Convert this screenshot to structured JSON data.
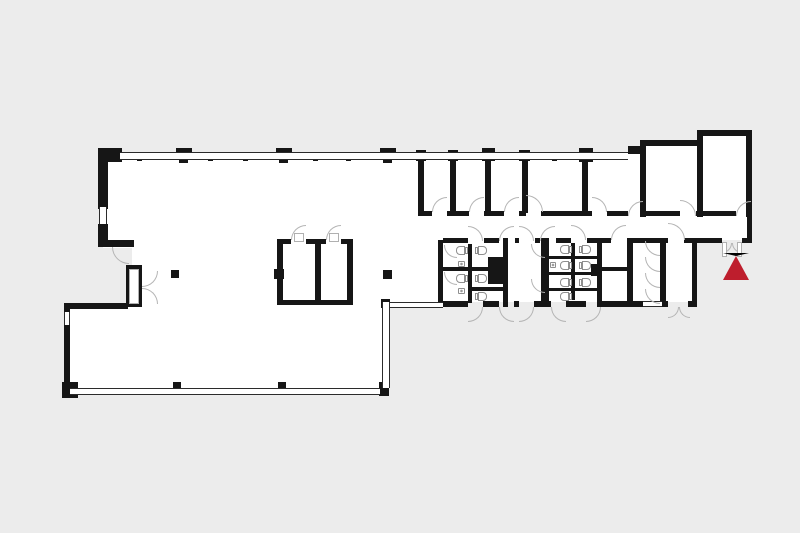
{
  "title": "Building floor plan with entrance marker",
  "canvas": {
    "width": 800,
    "height": 533
  },
  "colors": {
    "background": "#ececec",
    "floor": "#ffffff",
    "wall": "#161616",
    "window_line": "#2b2b2b",
    "door_arc": "#b5b5b5",
    "fixture_line": "#8f8f8f",
    "marker": "#be1e2d"
  },
  "marker": {
    "name": "entrance-marker",
    "apex_x": 736,
    "apex_y": 253,
    "half_width": 13,
    "height": 24
  },
  "floor_plan": {
    "floors": [
      [
        103,
        153,
        315,
        95
      ],
      [
        132,
        246,
        286,
        60
      ],
      [
        70,
        306,
        315,
        84
      ],
      [
        388,
        216,
        55,
        86
      ],
      [
        418,
        153,
        334,
        60
      ],
      [
        646,
        143,
        100,
        70
      ],
      [
        703,
        133,
        43,
        80
      ],
      [
        418,
        213,
        330,
        27
      ],
      [
        438,
        240,
        259,
        62
      ]
    ],
    "walls": [
      [
        98,
        148,
        24,
        14
      ],
      [
        98,
        148,
        10,
        61
      ],
      [
        98,
        224,
        10,
        23
      ],
      [
        98,
        240,
        36,
        7
      ],
      [
        126,
        265,
        16,
        42
      ],
      [
        64,
        303,
        64,
        6
      ],
      [
        64,
        303,
        6,
        83
      ],
      [
        62,
        382,
        16,
        16
      ],
      [
        379,
        382,
        10,
        14
      ],
      [
        381,
        299,
        9,
        9
      ],
      [
        137,
        152,
        5,
        9
      ],
      [
        208,
        152,
        5,
        9
      ],
      [
        243,
        152,
        5,
        9
      ],
      [
        313,
        152,
        5,
        9
      ],
      [
        346,
        152,
        5,
        9
      ],
      [
        552,
        152,
        5,
        9
      ],
      [
        176,
        148,
        16,
        7
      ],
      [
        179,
        154,
        9,
        9
      ],
      [
        276,
        148,
        16,
        7
      ],
      [
        279,
        154,
        9,
        9
      ],
      [
        380,
        148,
        16,
        7
      ],
      [
        383,
        154,
        9,
        9
      ],
      [
        170,
        389,
        15,
        6
      ],
      [
        173,
        382,
        8,
        8
      ],
      [
        275,
        389,
        15,
        6
      ],
      [
        278,
        382,
        8,
        8
      ],
      [
        416,
        150,
        10,
        11
      ],
      [
        418,
        155,
        6,
        58
      ],
      [
        448,
        150,
        10,
        11
      ],
      [
        450,
        155,
        6,
        58
      ],
      [
        482,
        148,
        13,
        13
      ],
      [
        485,
        155,
        6,
        58
      ],
      [
        519,
        150,
        11,
        11
      ],
      [
        522,
        155,
        6,
        58
      ],
      [
        579,
        148,
        14,
        14
      ],
      [
        582,
        155,
        6,
        58
      ],
      [
        628,
        146,
        14,
        8
      ],
      [
        640,
        140,
        6,
        77
      ],
      [
        640,
        140,
        62,
        6
      ],
      [
        697,
        130,
        6,
        87
      ],
      [
        697,
        130,
        55,
        6
      ],
      [
        746,
        130,
        6,
        87
      ],
      [
        747,
        211,
        5,
        32
      ],
      [
        418,
        211,
        14,
        5
      ],
      [
        447,
        211,
        22,
        5
      ],
      [
        484,
        211,
        20,
        5
      ],
      [
        519,
        211,
        7,
        5
      ],
      [
        541,
        211,
        51,
        5
      ],
      [
        607,
        211,
        21,
        5
      ],
      [
        643,
        211,
        37,
        5
      ],
      [
        696,
        211,
        40,
        5
      ],
      [
        443,
        238,
        25,
        5
      ],
      [
        484,
        238,
        15,
        5
      ],
      [
        515,
        238,
        4,
        5
      ],
      [
        535,
        238,
        5,
        5
      ],
      [
        556,
        238,
        15,
        5
      ],
      [
        587,
        238,
        24,
        5
      ],
      [
        627,
        238,
        41,
        5
      ],
      [
        684,
        238,
        13,
        5
      ],
      [
        697,
        238,
        25,
        5
      ],
      [
        742,
        238,
        10,
        5
      ],
      [
        438,
        240,
        5,
        63
      ],
      [
        468,
        244,
        4,
        59
      ],
      [
        503,
        238,
        5,
        69
      ],
      [
        443,
        267,
        29,
        4
      ],
      [
        472,
        267,
        31,
        4
      ],
      [
        472,
        287,
        31,
        4
      ],
      [
        488,
        257,
        15,
        27
      ],
      [
        541,
        238,
        8,
        69
      ],
      [
        571,
        243,
        4,
        57
      ],
      [
        597,
        238,
        5,
        69
      ],
      [
        549,
        256,
        48,
        3
      ],
      [
        549,
        272,
        48,
        3
      ],
      [
        549,
        288,
        48,
        3
      ],
      [
        591,
        264,
        8,
        12
      ],
      [
        601,
        267,
        26,
        4
      ],
      [
        627,
        238,
        6,
        69
      ],
      [
        660,
        238,
        6,
        69
      ],
      [
        692,
        238,
        5,
        69
      ],
      [
        438,
        301,
        30,
        6
      ],
      [
        483,
        301,
        16,
        6
      ],
      [
        514,
        301,
        5,
        6
      ],
      [
        534,
        301,
        17,
        6
      ],
      [
        566,
        301,
        20,
        6
      ],
      [
        601,
        301,
        42,
        6
      ],
      [
        662,
        301,
        6,
        6
      ],
      [
        688,
        301,
        9,
        6
      ],
      [
        277,
        239,
        6,
        66
      ],
      [
        315,
        239,
        6,
        66
      ],
      [
        347,
        239,
        6,
        66
      ],
      [
        277,
        239,
        14,
        5
      ],
      [
        306,
        239,
        20,
        5
      ],
      [
        341,
        239,
        12,
        5
      ],
      [
        277,
        300,
        76,
        5
      ],
      [
        274,
        269,
        10,
        10
      ],
      [
        171,
        270,
        8,
        8
      ],
      [
        383,
        270,
        9,
        9
      ]
    ],
    "windows": [
      {
        "r": [
          120,
          152,
          508,
          8
        ],
        "o": "h"
      },
      {
        "r": [
          99,
          207,
          8,
          17
        ],
        "o": "v"
      },
      {
        "r": [
          64,
          312,
          6,
          13
        ],
        "o": "v"
      },
      {
        "r": [
          70,
          388,
          310,
          7
        ],
        "o": "h"
      },
      {
        "r": [
          382,
          302,
          8,
          86
        ],
        "o": "v"
      },
      {
        "r": [
          390,
          302,
          53,
          6
        ],
        "o": "h"
      },
      {
        "r": [
          643,
          301,
          19,
          6
        ],
        "o": "h"
      }
    ],
    "doors": [
      {
        "x": 432,
        "y": 197,
        "r": 15,
        "q": "br"
      },
      {
        "x": 469,
        "y": 197,
        "r": 15,
        "q": "br"
      },
      {
        "x": 504,
        "y": 197,
        "r": 15,
        "q": "br"
      },
      {
        "x": 526,
        "y": 195,
        "r": 17,
        "q": "bl"
      },
      {
        "x": 592,
        "y": 197,
        "r": 15,
        "q": "bl"
      },
      {
        "x": 628,
        "y": 201,
        "r": 15,
        "q": "br"
      },
      {
        "x": 680,
        "y": 200,
        "r": 16,
        "q": "bl"
      },
      {
        "x": 736,
        "y": 201,
        "r": 15,
        "q": "br"
      },
      {
        "x": 468,
        "y": 226,
        "r": 15,
        "q": "bl"
      },
      {
        "x": 499,
        "y": 226,
        "r": 15,
        "q": "br"
      },
      {
        "x": 519,
        "y": 226,
        "r": 15,
        "q": "bl"
      },
      {
        "x": 540,
        "y": 226,
        "r": 15,
        "q": "br"
      },
      {
        "x": 571,
        "y": 225,
        "r": 15,
        "q": "bl"
      },
      {
        "x": 611,
        "y": 225,
        "r": 15,
        "q": "br"
      },
      {
        "x": 668,
        "y": 223,
        "r": 17,
        "q": "bl"
      },
      {
        "x": 291,
        "y": 225,
        "r": 15,
        "q": "br"
      },
      {
        "x": 326,
        "y": 225,
        "r": 15,
        "q": "br"
      },
      {
        "x": 468,
        "y": 307,
        "r": 15,
        "q": "tl"
      },
      {
        "x": 499,
        "y": 307,
        "r": 15,
        "q": "tr"
      },
      {
        "x": 519,
        "y": 307,
        "r": 15,
        "q": "tl"
      },
      {
        "x": 551,
        "y": 307,
        "r": 15,
        "q": "tr"
      },
      {
        "x": 586,
        "y": 307,
        "r": 15,
        "q": "tl"
      },
      {
        "x": 668,
        "y": 307,
        "r": 11,
        "q": "tl"
      },
      {
        "x": 679,
        "y": 307,
        "r": 11,
        "q": "tr"
      },
      {
        "x": 112,
        "y": 247,
        "r": 17,
        "q": "tr"
      },
      {
        "x": 142,
        "y": 271,
        "r": 16,
        "q": "tl"
      },
      {
        "x": 142,
        "y": 288,
        "r": 16,
        "q": "bl"
      },
      {
        "x": 722,
        "y": 243,
        "r": 10,
        "q": "tl"
      },
      {
        "x": 732,
        "y": 243,
        "r": 10,
        "q": "tr"
      },
      {
        "x": 444,
        "y": 245,
        "r": 13,
        "q": "tr"
      },
      {
        "x": 444,
        "y": 272,
        "r": 13,
        "q": "tr"
      },
      {
        "x": 531,
        "y": 244,
        "r": 14,
        "q": "tr"
      },
      {
        "x": 531,
        "y": 279,
        "r": 14,
        "q": "tr"
      },
      {
        "x": 645,
        "y": 241,
        "r": 15,
        "q": "tr"
      },
      {
        "x": 645,
        "y": 257,
        "r": 15,
        "q": "tr"
      },
      {
        "x": 645,
        "y": 273,
        "r": 15,
        "q": "tr"
      },
      {
        "x": 645,
        "y": 289,
        "r": 15,
        "q": "tr"
      }
    ],
    "leaves": [
      [
        129,
        269,
        10,
        35
      ],
      [
        722,
        242,
        5,
        15
      ],
      [
        737,
        242,
        5,
        15
      ],
      [
        294,
        233,
        10,
        9
      ],
      [
        329,
        233,
        10,
        9
      ]
    ],
    "toilets": [
      {
        "x": 456,
        "y": 246,
        "t": "r"
      },
      {
        "x": 456,
        "y": 274,
        "t": "r"
      },
      {
        "x": 478,
        "y": 246,
        "t": "l"
      },
      {
        "x": 478,
        "y": 274,
        "t": "l"
      },
      {
        "x": 478,
        "y": 292,
        "t": "l"
      },
      {
        "x": 560,
        "y": 245,
        "t": "r"
      },
      {
        "x": 582,
        "y": 245,
        "t": "l"
      },
      {
        "x": 560,
        "y": 261,
        "t": "r"
      },
      {
        "x": 582,
        "y": 261,
        "t": "l"
      },
      {
        "x": 560,
        "y": 278,
        "t": "r"
      },
      {
        "x": 582,
        "y": 278,
        "t": "l"
      },
      {
        "x": 560,
        "y": 292,
        "t": "r"
      }
    ],
    "sinks": [
      [
        458,
        261,
        7,
        6
      ],
      [
        458,
        288,
        7,
        6
      ],
      [
        550,
        262,
        6,
        6
      ]
    ]
  }
}
